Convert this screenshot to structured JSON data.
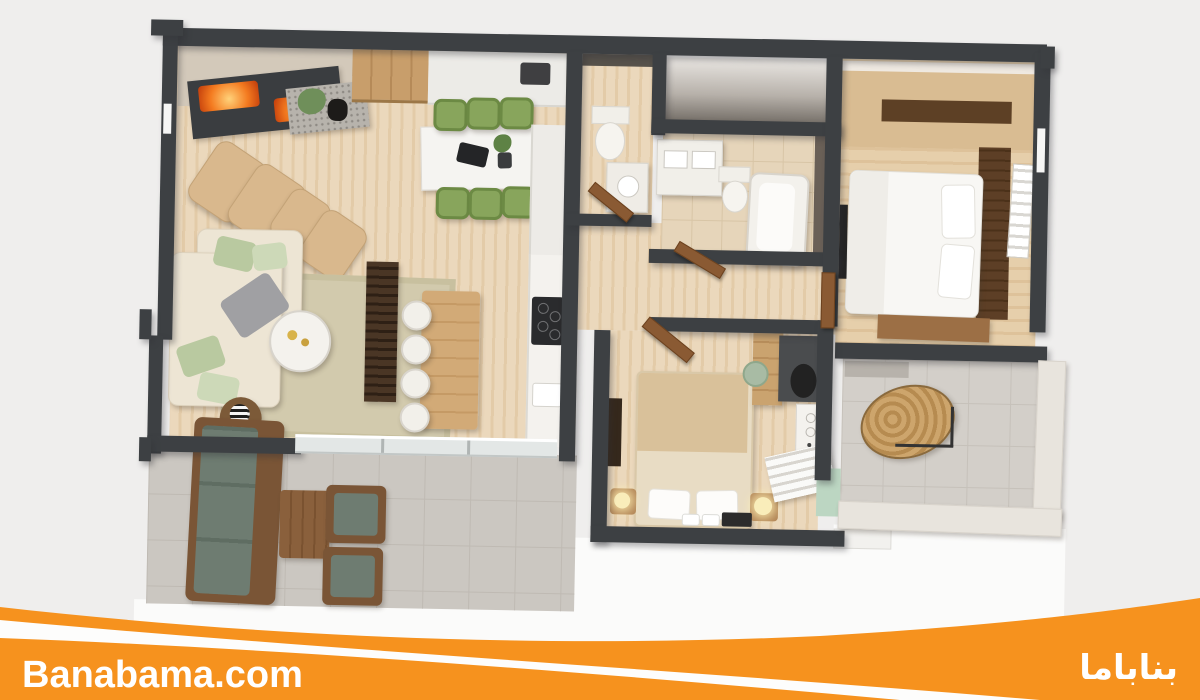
{
  "brand": {
    "site_en": "Banabama.com",
    "site_fa": "بناباما"
  },
  "banner": {
    "background": "#F6921E",
    "swoosh": "#FDFDFC",
    "text_color": "#FFFFFF"
  },
  "scene": {
    "type": "3d-apartment-floor-plan-render",
    "background": "#EFEEED",
    "wall_color": "#3D4043",
    "wood_floor_color": "#E7D3B5",
    "terrace_tile_color": "#CBC7C1",
    "dining_chair_color": "#88A55C",
    "outdoor_cushion_color": "#6E7C71",
    "fireplace_flame_color": "#F47B20"
  }
}
